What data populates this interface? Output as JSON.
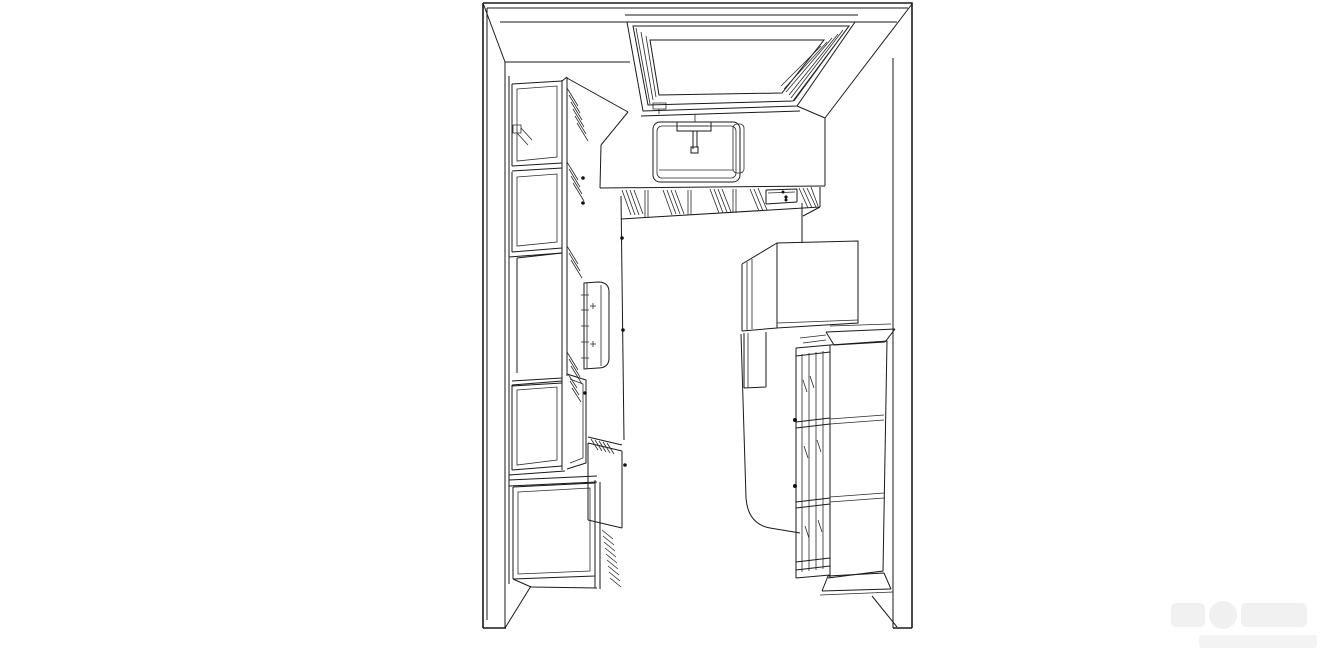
{
  "canvas": {
    "width": 1329,
    "height": 665,
    "background": "#ffffff",
    "line_color": "#1a1a1a"
  },
  "scene": {
    "kind": "perspective top-down line drawing of a galley kitchen (CAD wireframe, no text labels)",
    "elements": [
      "room-walls",
      "window",
      "sink",
      "faucet",
      "sink-counter-run",
      "under-counter-cabinets",
      "left-tall-cabinet-run",
      "wall-switch-symbol",
      "range-cooktop",
      "base-cabinet",
      "corner-base-cabinet",
      "refrigerator",
      "display-hutch",
      "floor"
    ]
  },
  "watermark": {
    "color": "#f1f1f1",
    "legible_text": ""
  }
}
